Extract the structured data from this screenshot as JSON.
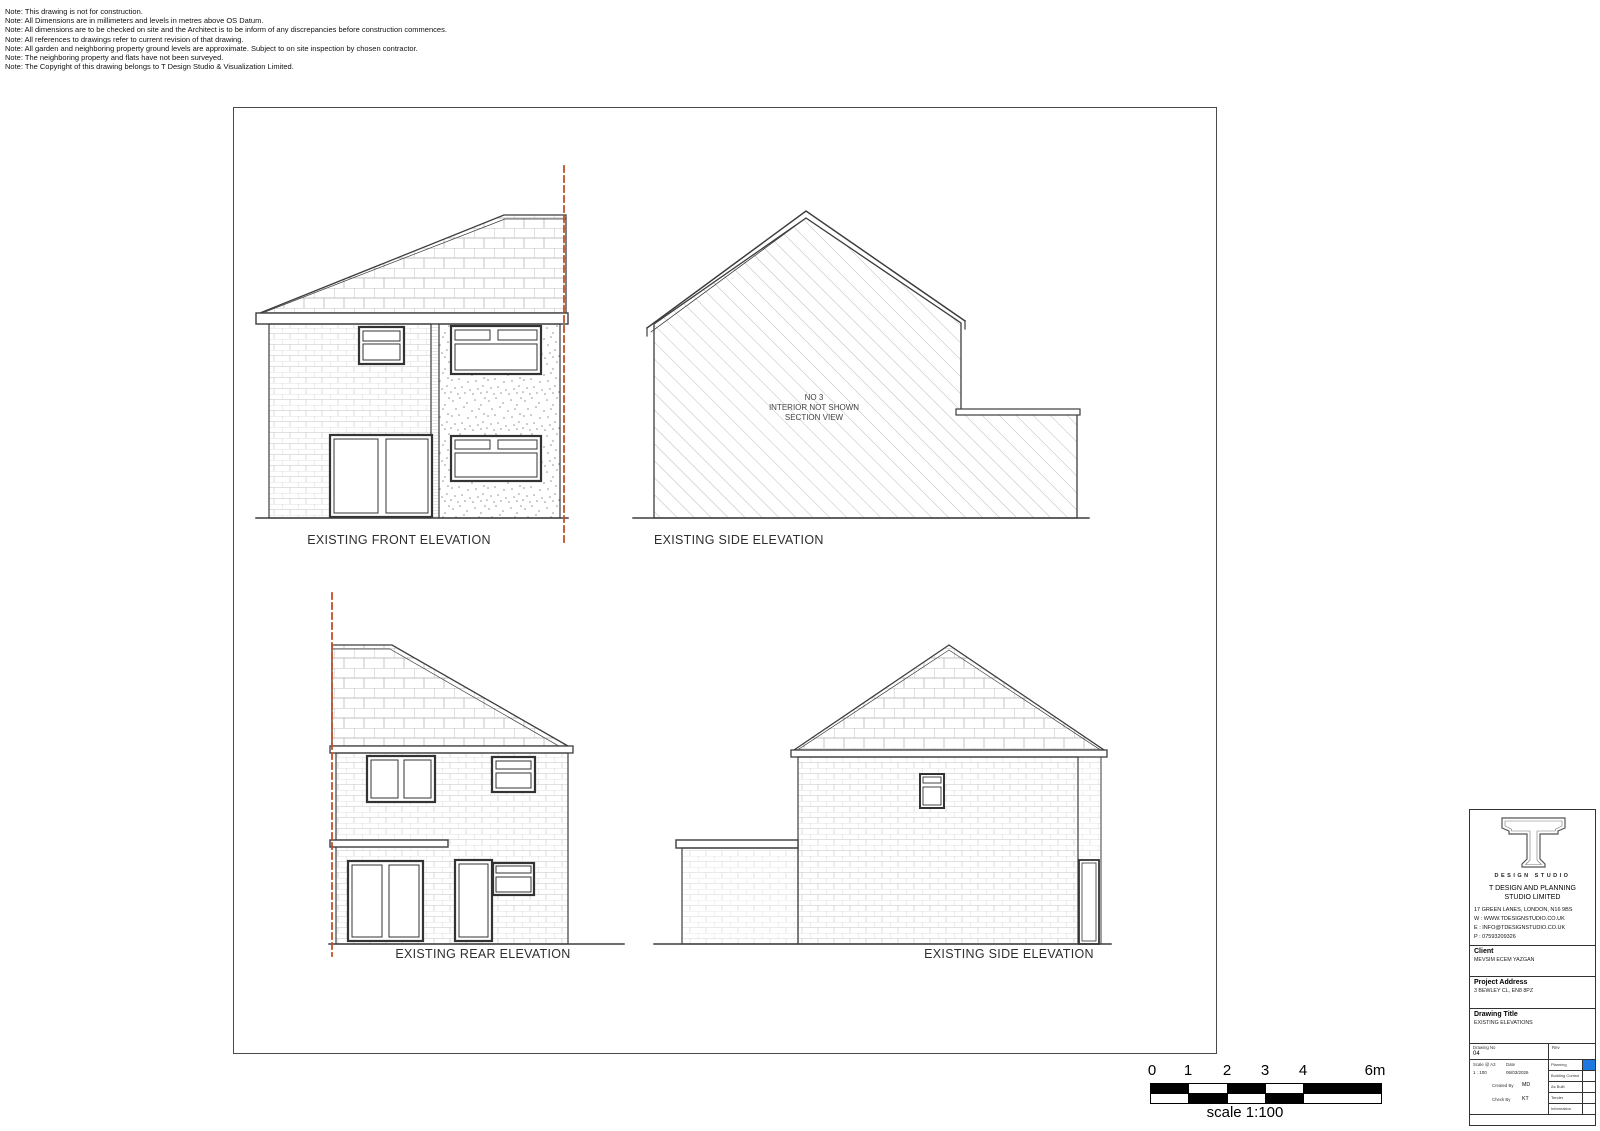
{
  "notes": [
    "Note: This drawing is not for construction.",
    "Note: All Dimensions are in millimeters and levels in metres above OS Datum.",
    "Note: All dimensions are to be checked on site and the Architect is to be inform of any discrepancies before construction commences.",
    "Note: All references to drawings refer to current revision of that drawing.",
    "Note: All garden and neighboring property ground levels are approximate. Subject to on site inspection by chosen contractor.",
    "Note: The neighboring property and flats have not been surveyed.",
    "Note: The Copyright of this drawing belongs to T Design Studio & Visualization Limited."
  ],
  "elevations": {
    "front": {
      "label": "EXISTING FRONT ELEVATION"
    },
    "side_top": {
      "label": "EXISTING SIDE ELEVATION",
      "annotation": [
        "NO 3",
        "INTERIOR NOT SHOWN",
        "SECTION VIEW"
      ]
    },
    "rear": {
      "label": "EXISTING REAR ELEVATION"
    },
    "side_bottom": {
      "label": "EXISTING SIDE ELEVATION"
    }
  },
  "scale_bar": {
    "ticks": [
      "0",
      "1",
      "2",
      "3",
      "4",
      "6m"
    ],
    "caption": "scale 1:100"
  },
  "title_block": {
    "logo_text": "DESIGN STUDIO",
    "company": "T DESIGN AND PLANNING STUDIO LIMITED",
    "address": "17 GREEN LANES, LONDON, N16 9BS",
    "web": "W : WWW.TDESIGNSTUDIO.CO.UK",
    "email": "E : INFO@TDESIGNSTUDIO.CO.UK",
    "phone": "P : 07593209326",
    "client_label": "Client",
    "client": "MEVSIM ECEM YAZGAN",
    "project_address_label": "Project Address",
    "project_address": "3 BEWLEY CL, EN8 8PZ",
    "drawing_title_label": "Drawing Title",
    "drawing_title": "EXISTING ELEVATIONS",
    "drawing_no_label": "Drawing No",
    "drawing_no": "04",
    "rev_label": "Rev",
    "scale_label": "Scale @ A3",
    "scale": "1 : 100",
    "date_label": "Date",
    "date": "06/03/2026",
    "created_by_label": "Created By",
    "created_by": "MD",
    "check_by_label": "Check By",
    "check_by": "KT",
    "statuses": [
      "Planning",
      "Building Control",
      "As Built",
      "Tender",
      "Information"
    ],
    "active_status": "Planning",
    "colors": {
      "active_status_box": "#1e78e0",
      "boundary_line": "#c24e2b"
    }
  }
}
